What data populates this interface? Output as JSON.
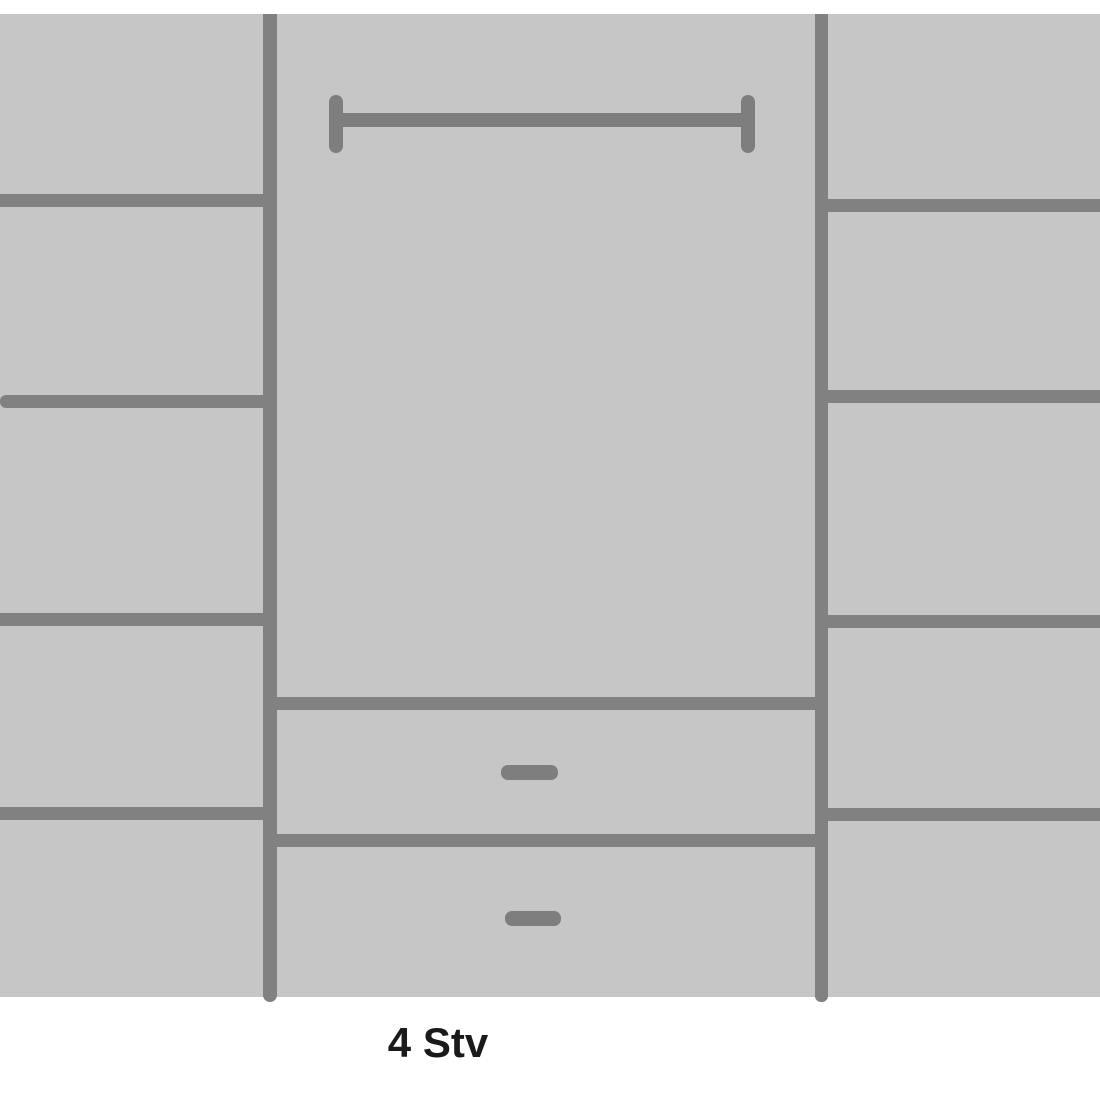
{
  "diagram": {
    "type": "wardrobe-front-elevation",
    "label": "4 Stv",
    "colors": {
      "background": "#ffffff",
      "panel": "#c6c6c6",
      "line": "#818181",
      "rail": "#7e7e7e",
      "text": "#1a1a1a"
    },
    "structure": {
      "left_column_compartments": 5,
      "right_column_compartments": 5,
      "middle_section": {
        "hanging_rail": true,
        "drawers": 2
      }
    },
    "canvas": {
      "width": 1100,
      "height": 1100
    },
    "shapes": [
      {
        "name": "wardrobe-body-panel",
        "x": 0,
        "y": 14,
        "w": 1100,
        "h": 983,
        "color": "panel"
      },
      {
        "name": "left-vertical-divider",
        "x": 263,
        "y": 14,
        "w": 14,
        "h": 988,
        "color": "line",
        "r": "0 0 7px 7px"
      },
      {
        "name": "right-vertical-divider",
        "x": 815,
        "y": 14,
        "w": 13,
        "h": 988,
        "color": "line",
        "r": "0 0 6px 6px"
      },
      {
        "name": "left-shelf-line-1",
        "x": 0,
        "y": 194,
        "w": 277,
        "h": 13,
        "color": "line"
      },
      {
        "name": "left-shelf-line-2",
        "x": 0,
        "y": 395,
        "w": 277,
        "h": 13,
        "color": "line",
        "r": "6px 0 0 6px"
      },
      {
        "name": "left-shelf-line-3",
        "x": 0,
        "y": 613,
        "w": 277,
        "h": 13,
        "color": "line"
      },
      {
        "name": "left-shelf-line-4",
        "x": 0,
        "y": 807,
        "w": 277,
        "h": 13,
        "color": "line"
      },
      {
        "name": "right-shelf-line-1",
        "x": 815,
        "y": 199,
        "w": 285,
        "h": 13,
        "color": "line"
      },
      {
        "name": "right-shelf-line-2",
        "x": 815,
        "y": 390,
        "w": 285,
        "h": 13,
        "color": "line"
      },
      {
        "name": "right-shelf-line-3",
        "x": 815,
        "y": 615,
        "w": 285,
        "h": 13,
        "color": "line"
      },
      {
        "name": "right-shelf-line-4",
        "x": 815,
        "y": 808,
        "w": 285,
        "h": 13,
        "color": "line"
      },
      {
        "name": "drawer-1-top-line",
        "x": 277,
        "y": 697,
        "w": 538,
        "h": 13,
        "color": "line"
      },
      {
        "name": "drawer-2-top-line",
        "x": 277,
        "y": 834,
        "w": 538,
        "h": 13,
        "color": "line"
      },
      {
        "name": "clothes-rail-bar",
        "x": 336,
        "y": 113,
        "w": 412,
        "h": 14,
        "color": "rail"
      },
      {
        "name": "clothes-rail-left-cap",
        "x": 329,
        "y": 95,
        "w": 14,
        "h": 58,
        "color": "rail",
        "r": "7px"
      },
      {
        "name": "clothes-rail-right-cap",
        "x": 741,
        "y": 95,
        "w": 14,
        "h": 58,
        "color": "rail",
        "r": "7px"
      },
      {
        "name": "drawer-1-handle",
        "x": 501,
        "y": 765,
        "w": 57,
        "h": 15,
        "color": "rail",
        "r": "7px"
      },
      {
        "name": "drawer-2-handle",
        "x": 505,
        "y": 911,
        "w": 56,
        "h": 15,
        "color": "rail",
        "r": "7px"
      }
    ]
  }
}
